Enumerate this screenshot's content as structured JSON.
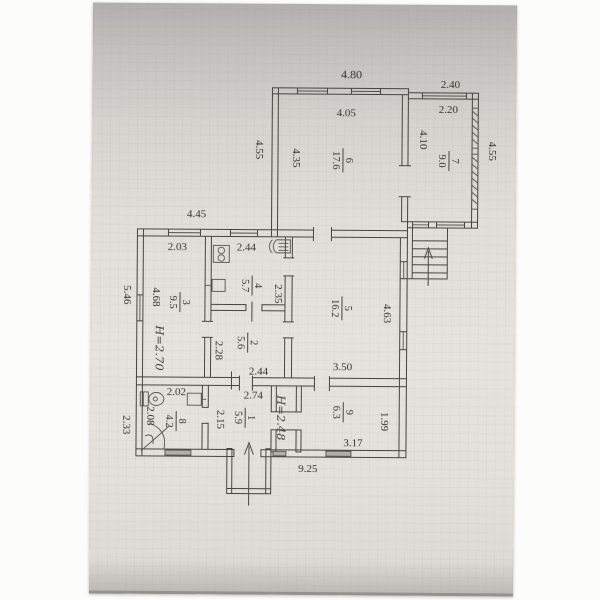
{
  "plan": {
    "rooms": [
      {
        "number": "1",
        "area": "5.9",
        "width": "2.74",
        "height": "2.15",
        "note": "H=2.48"
      },
      {
        "number": "2",
        "area": "5.6",
        "width": "2.44",
        "height": "2.28"
      },
      {
        "number": "3",
        "area": "9.5",
        "width": "2.03",
        "height": "4.68",
        "note": "H=2.70"
      },
      {
        "number": "4",
        "area": "5.7",
        "width": "2.44",
        "height": "2.35"
      },
      {
        "number": "5",
        "area": "16.2",
        "width": "3.50",
        "height": "4.63"
      },
      {
        "number": "6",
        "area": "17.6",
        "width": "4.05",
        "height": "4.35"
      },
      {
        "number": "7",
        "area": "9.0",
        "width": "2.20",
        "height": "4.10"
      },
      {
        "number": "8",
        "area": "4.2",
        "width": "2.02",
        "height": "2.08"
      },
      {
        "number": "9",
        "area": "6.3",
        "width": "3.17",
        "height": "1.99"
      }
    ],
    "exterior_dimensions": {
      "top_main": "4.80",
      "annex_top": "2.40",
      "left_upper": "4.55",
      "mid_left_top": "4.45",
      "left_mid": "5.46",
      "left_bottom": "2.33",
      "annex_right": "4.55",
      "bottom_total": "9.25"
    },
    "icons": [
      "stove-icon",
      "water-heater-icon",
      "kitchen-sink-icon",
      "toilet-icon",
      "washbasin-icon",
      "corner-bath-icon",
      "stairs-icon",
      "entrance-arrow-icon",
      "stairs-arrow-icon"
    ],
    "colors": {
      "paper_top": "#b2b0ae",
      "paper_main": "#e4e1dc",
      "line": "#47443f",
      "text": "#35322d",
      "vent_fill": "#b2afaa"
    }
  }
}
